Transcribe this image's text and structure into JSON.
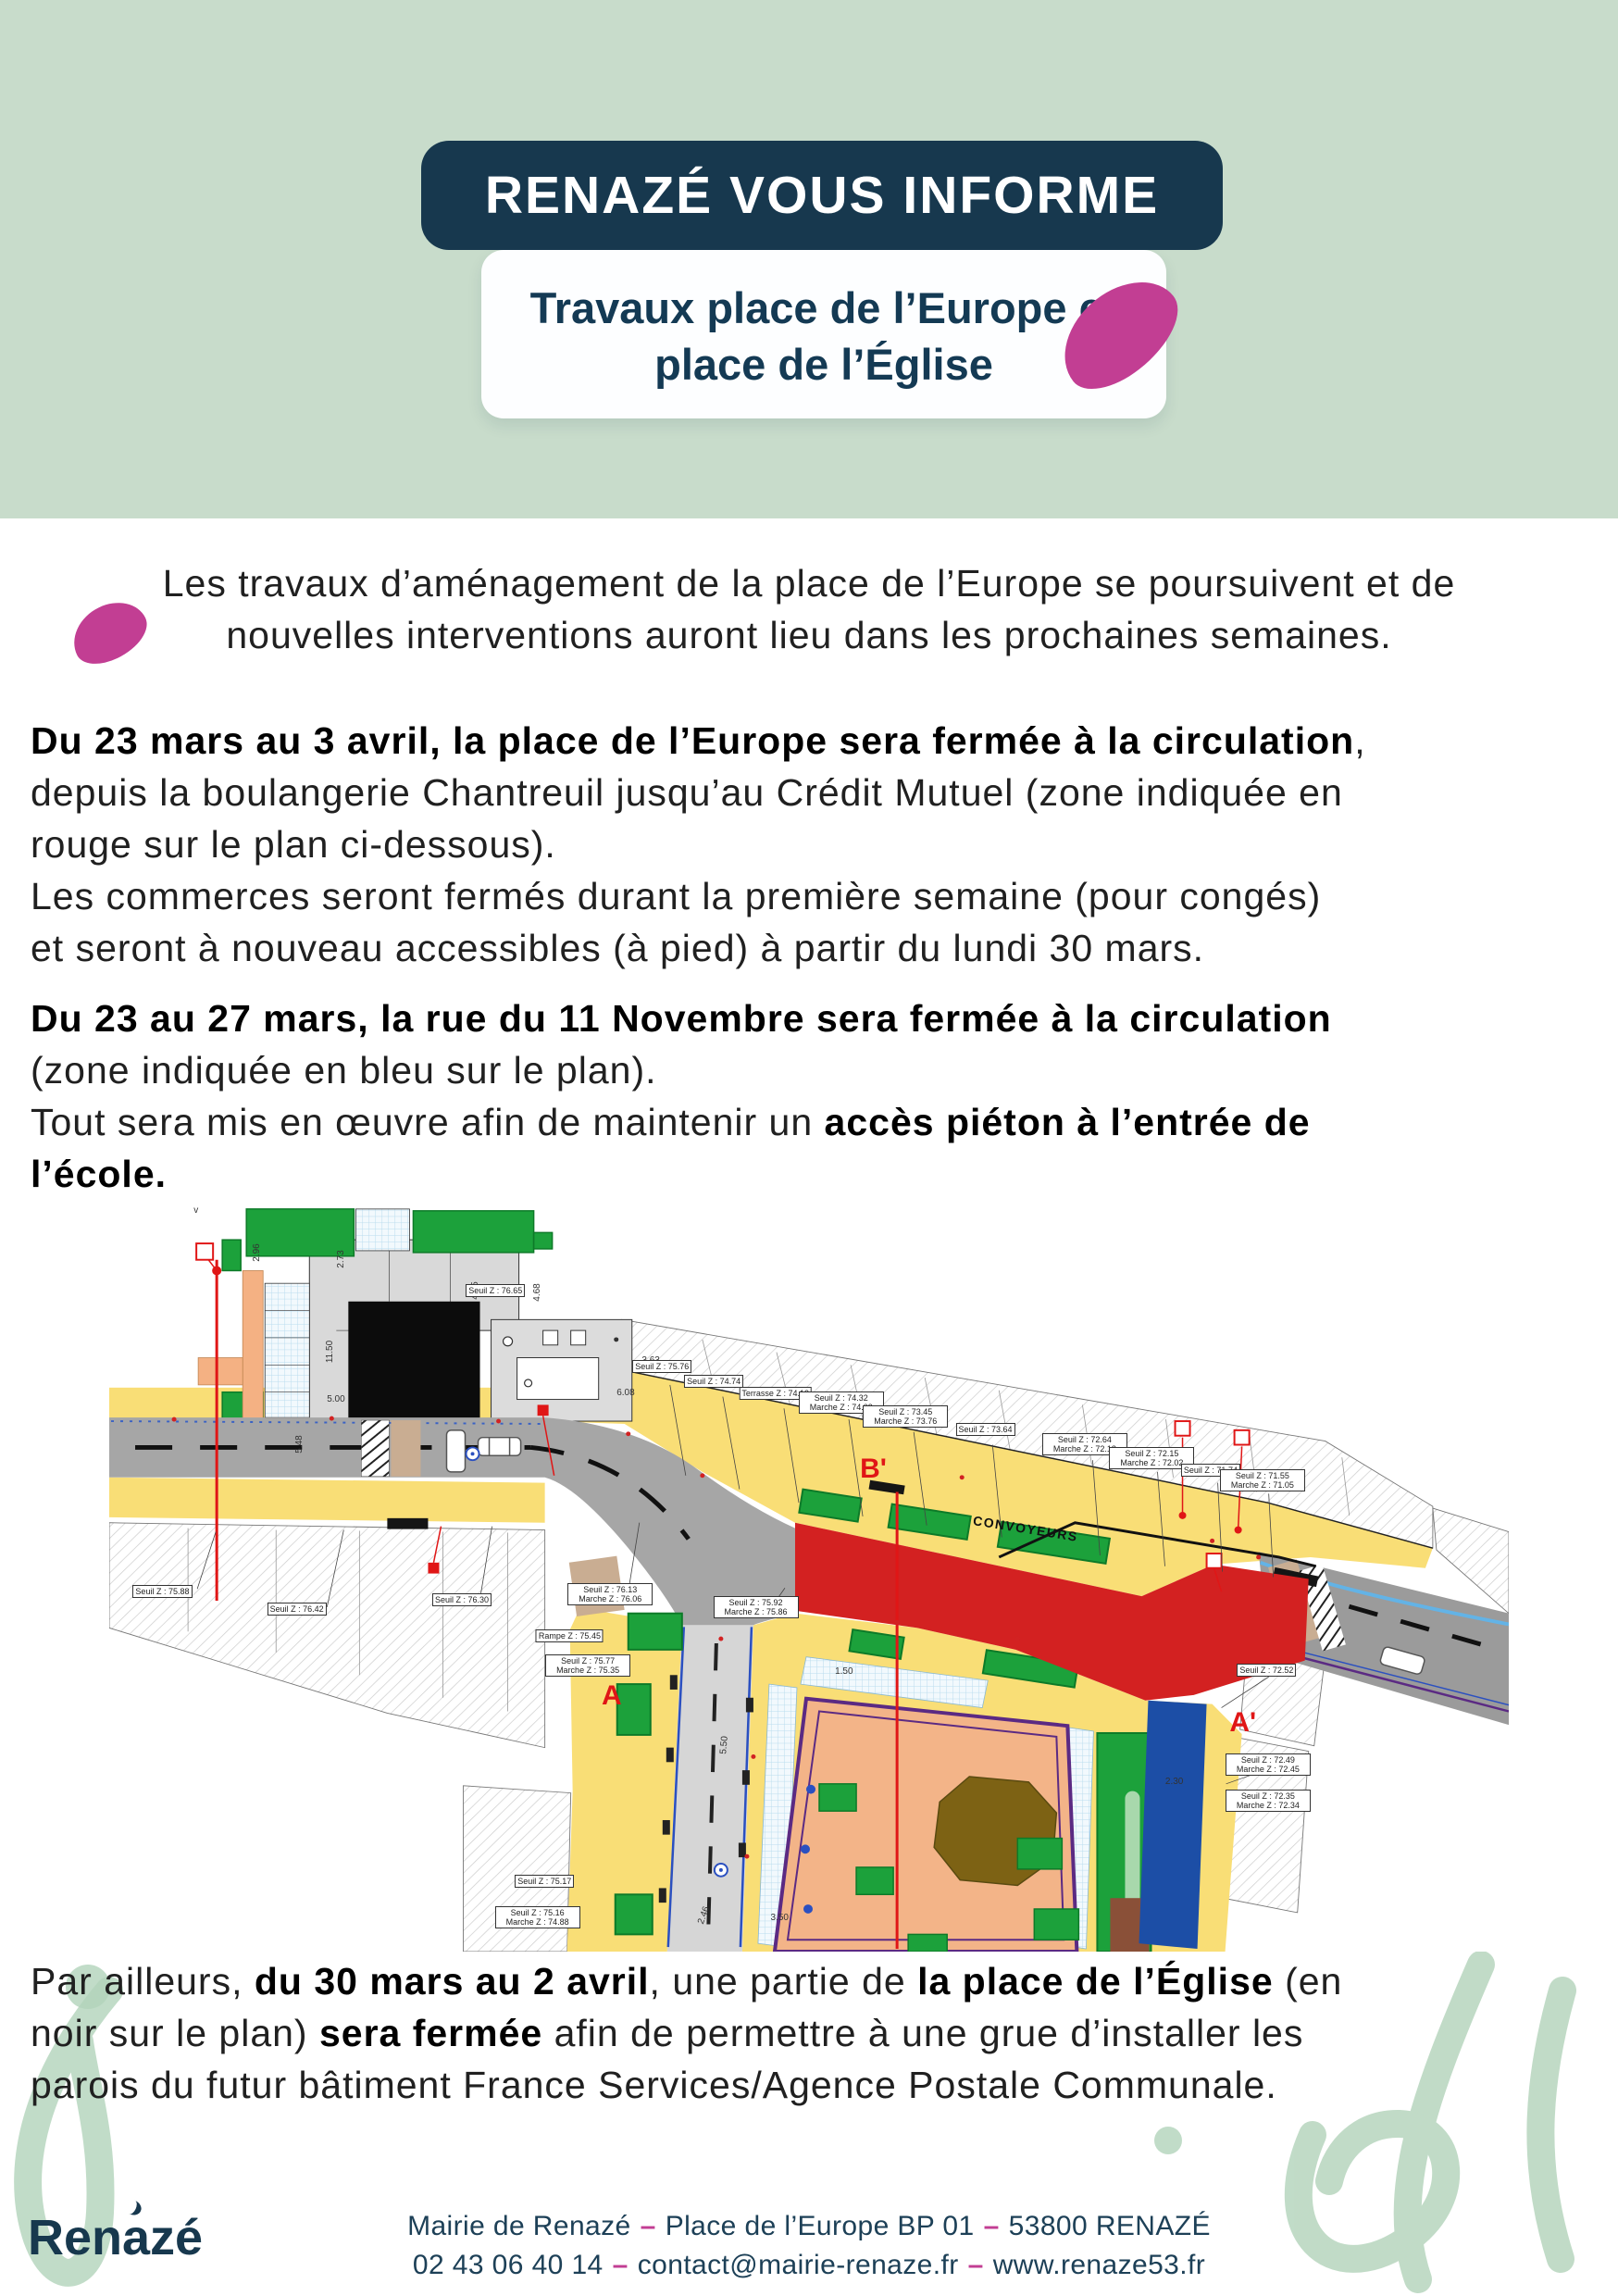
{
  "page": {
    "colors": {
      "mint": "#c8dccb",
      "navy": "#17384e",
      "magenta": "#c23e93",
      "map_red_zone": "#d32121",
      "map_blue_zone": "#1c4ea6",
      "map_black_zone": "#0c0c0c",
      "map_yellow": "#f9de76",
      "map_green": "#1ca13b",
      "flourish_green": "#b2d3ba"
    }
  },
  "header": {
    "banner_title": "RENAZÉ VOUS INFORME",
    "subtitle_line1": "Travaux place de l’Europe et",
    "subtitle_line2": "place de l’Église"
  },
  "intro": {
    "line1": "Les travaux d’aménagement de la place de l’Europe se poursuivent et de",
    "line2": "nouvelles interventions auront lieu dans les prochaines semaines."
  },
  "closure_europe": {
    "line1_bold": "Du 23 mars au 3 avril, la place de l’Europe sera fermée à la circulation",
    "line1_tail": ",",
    "line2": "depuis la boulangerie Chantreuil jusqu’au Crédit Mutuel (zone indiquée en",
    "line3": "rouge sur le plan ci-dessous).",
    "line4": "Les commerces seront fermés durant la première semaine (pour congés)",
    "line5": "et seront à nouveau accessibles (à pied) à partir du lundi 30 mars."
  },
  "closure_novembre": {
    "line1_bold": "Du 23 au 27 mars, la rue du 11 Novembre sera fermée à la circulation",
    "line2": "(zone indiquée en bleu sur le plan).",
    "line3_pre": "Tout sera mis en œuvre afin de maintenir un ",
    "line3_bold": "accès piéton à l’entrée de",
    "line4_bold": "l’école."
  },
  "closure_eglise": {
    "line1_pre": "Par ailleurs, ",
    "line1_bold1": "du 30 mars au 2 avril",
    "line1_mid": ", une partie de ",
    "line1_bold2": "la place de l’Église",
    "line1_tail": " (en",
    "line2_pre": "noir sur le plan) ",
    "line2_bold": "sera fermée",
    "line2_tail": " afin de permettre à une grue d’installer les",
    "line3": "parois du futur bâtiment France Services/Agence Postale Communale."
  },
  "map": {
    "section_labels": [
      {
        "text": "A",
        "x": 35.9,
        "y": 65.8
      },
      {
        "text": "A'",
        "x": 81.0,
        "y": 69.4
      },
      {
        "text": "B'",
        "x": 54.6,
        "y": 35.5
      }
    ],
    "road_label": {
      "text": "CONVOYEURS",
      "x": 65.5,
      "y": 43.5,
      "rot": 9
    },
    "callouts": [
      {
        "text": "Seuil Z : 75.88",
        "x": 3.8,
        "y": 51.8
      },
      {
        "text": "Seuil Z : 76.42",
        "x": 13.4,
        "y": 54.2
      },
      {
        "text": "Seuil Z : 76.30",
        "x": 25.2,
        "y": 53.0
      },
      {
        "text": "Seuil Z : 76.13 Marche Z : 76.06",
        "x": 35.8,
        "y": 52.2
      },
      {
        "text": "Seuil Z : 75.92 Marche Z : 75.86",
        "x": 46.2,
        "y": 54.0
      },
      {
        "text": "Seuil Z : 76.65",
        "x": 27.6,
        "y": 11.6
      },
      {
        "text": "Seuil Z : 75.76",
        "x": 39.5,
        "y": 21.8
      },
      {
        "text": "Seuil Z : 74.74",
        "x": 43.2,
        "y": 23.8
      },
      {
        "text": "Terrasse Z : 74.13",
        "x": 47.6,
        "y": 25.4
      },
      {
        "text": "Seuil Z : 74.32 Marche Z : 74.03",
        "x": 52.3,
        "y": 26.6
      },
      {
        "text": "Seuil Z : 73.45 Marche Z : 73.76",
        "x": 56.9,
        "y": 28.5
      },
      {
        "text": "Seuil Z : 73.64",
        "x": 62.6,
        "y": 30.2
      },
      {
        "text": "Seuil Z : 72.64 Marche Z : 72.18",
        "x": 69.7,
        "y": 32.2
      },
      {
        "text": "Seuil Z : 72.15 Marche Z : 72.02",
        "x": 74.5,
        "y": 34.0
      },
      {
        "text": "Seuil Z : 71.74",
        "x": 78.7,
        "y": 35.6
      },
      {
        "text": "Seuil Z : 71.55 Marche Z : 71.05",
        "x": 82.4,
        "y": 37.0
      },
      {
        "text": "Seuil Z : 72.52",
        "x": 82.7,
        "y": 62.4
      },
      {
        "text": "Seuil Z : 72.49 Marche Z : 72.45",
        "x": 82.8,
        "y": 75.0
      },
      {
        "text": "Seuil Z : 72.35 Marche Z : 72.34",
        "x": 82.8,
        "y": 79.8
      },
      {
        "text": "Seuil Z : 75.77 Marche Z : 75.35",
        "x": 34.2,
        "y": 61.8
      },
      {
        "text": "Seuil Z : 75.17",
        "x": 31.1,
        "y": 90.6
      },
      {
        "text": "Seuil Z : 75.16 Marche Z : 74.88",
        "x": 30.6,
        "y": 95.4
      },
      {
        "text": "Rampe Z : 75.45",
        "x": 32.9,
        "y": 57.8
      }
    ],
    "dims": [
      {
        "text": "11.50",
        "x": 15.8,
        "y": 19.8,
        "rot": -90
      },
      {
        "text": "2.73",
        "x": 16.6,
        "y": 7.4,
        "rot": -90
      },
      {
        "text": "2.96",
        "x": 10.6,
        "y": 6.6,
        "rot": -90
      },
      {
        "text": "4.65",
        "x": 26.2,
        "y": 11.6,
        "rot": -90
      },
      {
        "text": "4.68",
        "x": 30.6,
        "y": 11.9,
        "rot": -90
      },
      {
        "text": "5.00",
        "x": 16.2,
        "y": 26.2,
        "rot": 0
      },
      {
        "text": "3.63",
        "x": 38.7,
        "y": 21.0,
        "rot": 0
      },
      {
        "text": "5.48",
        "x": 13.6,
        "y": 32.2,
        "rot": -90
      },
      {
        "text": "5.50",
        "x": 44.0,
        "y": 72.4,
        "rot": -85
      },
      {
        "text": "1.50",
        "x": 52.5,
        "y": 62.6,
        "rot": 0
      },
      {
        "text": "2.30",
        "x": 76.1,
        "y": 77.3,
        "rot": 0
      },
      {
        "text": "6.08",
        "x": 36.9,
        "y": 25.4,
        "rot": 0
      },
      {
        "text": "3.50",
        "x": 47.9,
        "y": 95.5,
        "rot": 0
      },
      {
        "text": "2.46",
        "x": 42.5,
        "y": 95.2,
        "rot": -70
      },
      {
        "text": "v",
        "x": 6.2,
        "y": 1.0,
        "rot": 0
      }
    ]
  },
  "footer": {
    "logo_text": "Renazé",
    "separator": "–",
    "address_parts": [
      "Mairie de Renazé",
      "Place de l’Europe BP 01",
      "53800 RENAZÉ"
    ],
    "contact_parts": [
      "02 43 06 40 14",
      "contact@mairie-renaze.fr",
      "www.renaze53.fr"
    ]
  }
}
